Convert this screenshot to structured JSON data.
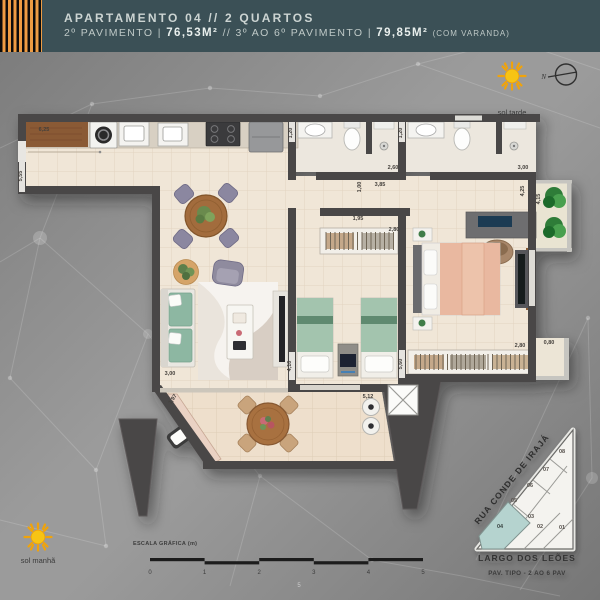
{
  "colors": {
    "header_bg": "#3b5056",
    "stripe_orange": "#ee9c43",
    "sun_yellow": "#f7c414",
    "wall": "#4a4647",
    "floor": "#f0e6d7",
    "unit_highlight": "#b5d3cf"
  },
  "header": {
    "line1": "APARTAMENTO 04 // 2 QUARTOS",
    "line2": {
      "part1": "2º PAVIMENTO | ",
      "area1": "76,53M²",
      "part2": " // 3º AO 6º PAVIMENTO | ",
      "area2": "79,85M²",
      "suffix": "(COM VARANDA)"
    }
  },
  "orientation": {
    "sun_afternoon": "sol tarde",
    "sun_morning": "sol manhã",
    "compass_north": "N"
  },
  "floorplan": {
    "dimensions": [
      {
        "label": "6,25",
        "x": 44,
        "y": 131,
        "rot": 0
      },
      {
        "label": "5,55",
        "x": 22,
        "y": 176,
        "rot": -90
      },
      {
        "label": "1,20",
        "x": 292,
        "y": 133,
        "rot": -90
      },
      {
        "label": "1,20",
        "x": 402,
        "y": 133,
        "rot": -90
      },
      {
        "label": "2,60",
        "x": 393,
        "y": 169,
        "rot": 0
      },
      {
        "label": "3,00",
        "x": 523,
        "y": 169,
        "rot": 0
      },
      {
        "label": "1,00",
        "x": 361,
        "y": 187,
        "rot": -90
      },
      {
        "label": "3,85",
        "x": 380,
        "y": 186,
        "rot": 0
      },
      {
        "label": "4,25",
        "x": 524,
        "y": 191,
        "rot": -90
      },
      {
        "label": "4,15",
        "x": 540,
        "y": 199,
        "rot": -90
      },
      {
        "label": "1,95",
        "x": 358,
        "y": 220,
        "rot": 0
      },
      {
        "label": "2,80",
        "x": 394,
        "y": 231,
        "rot": 0
      },
      {
        "label": "5,60",
        "x": 402,
        "y": 364,
        "rot": -90
      },
      {
        "label": "2,80",
        "x": 520,
        "y": 347,
        "rot": 0
      },
      {
        "label": "0,80",
        "x": 549,
        "y": 344,
        "rot": 0
      },
      {
        "label": "3,00",
        "x": 170,
        "y": 375,
        "rot": 0
      },
      {
        "label": "4,10",
        "x": 291,
        "y": 366,
        "rot": -90
      },
      {
        "label": "1,97",
        "x": 174,
        "y": 400,
        "rot": -55
      },
      {
        "label": "5,12",
        "x": 368,
        "y": 398,
        "rot": 0
      }
    ]
  },
  "scale_bar": {
    "title": "ESCALA GRÁFICA (m)",
    "ticks": [
      "0",
      "1",
      "2",
      "3",
      "4",
      "5"
    ]
  },
  "minimap": {
    "street_diagonal": "RUA CONDE DE IRAJÁ",
    "street_bottom": "LARGO DOS LEÕES",
    "caption": "PAV. TIPO - 2 AO 6 PAV",
    "highlighted_unit": "04",
    "units": [
      {
        "label": "08",
        "x": 562,
        "y": 453
      },
      {
        "label": "07",
        "x": 546,
        "y": 471
      },
      {
        "label": "06",
        "x": 530,
        "y": 487
      },
      {
        "label": "05",
        "x": 514,
        "y": 502
      },
      {
        "label": "04",
        "x": 500,
        "y": 528
      },
      {
        "label": "03",
        "x": 531,
        "y": 518
      },
      {
        "label": "02",
        "x": 540,
        "y": 528
      },
      {
        "label": "01",
        "x": 562,
        "y": 529
      }
    ]
  },
  "page_marker": "5"
}
